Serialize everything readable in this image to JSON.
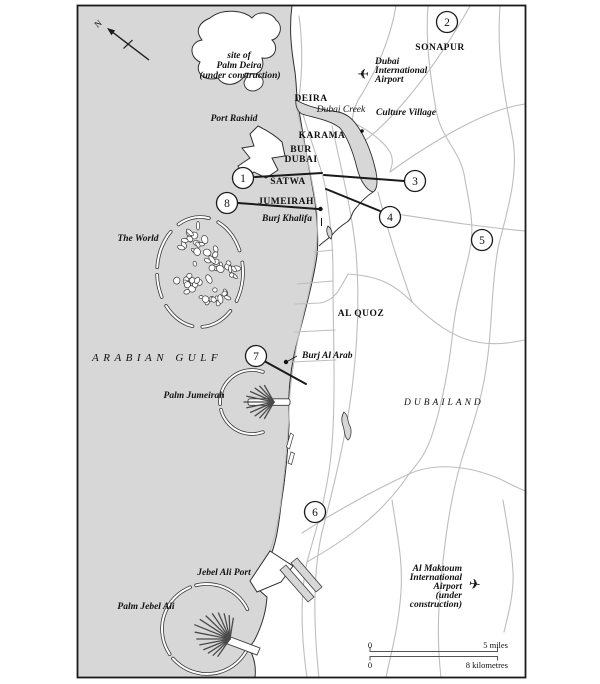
{
  "map_type": "city-map",
  "city": "Dubai",
  "colors": {
    "sea": "#d7d7d7",
    "land": "#ffffff",
    "road": "#bdbdbd",
    "coast_outline": "#2e2e2e",
    "text": "#111111",
    "frame": "#1a1a1a"
  },
  "compass": {
    "north_label": "N"
  },
  "regions": {
    "deira": "DEIRA",
    "karama": "KARAMA",
    "bur": "BUR",
    "dubai": "DUBAI",
    "satwa": "SATWA",
    "jumeirah": "JUMEIRAH",
    "sonapur": "SONAPUR",
    "al_quoz": "AL QUOZ",
    "dubailand": "DUBAILAND"
  },
  "water": {
    "gulf": "ARABIAN GULF",
    "creek": "Dubai Creek"
  },
  "landmarks": {
    "palm_deira_site": {
      "line1": "site of",
      "line2": "Palm Deira",
      "line3": "(under construction)"
    },
    "port_rashid": "Port Rashid",
    "culture_village": "Culture Village",
    "dubai_airport": {
      "line1": "Dubai",
      "line2": "International",
      "line3": "Airport"
    },
    "the_world": "The World",
    "burj_khalifa": "Burj Khalifa",
    "burj_al_arab": "Burj Al Arab",
    "palm_jumeirah": "Palm Jumeirah",
    "jebel_ali_port": "Jebel Ali Port",
    "palm_jebel_ali": "Palm Jebel Ali",
    "al_maktoum_airport": {
      "line1": "Al Maktoum",
      "line2": "International",
      "line3": "Airport",
      "line4": "(under",
      "line5": "construction)"
    }
  },
  "markers": [
    {
      "number": "1"
    },
    {
      "number": "2"
    },
    {
      "number": "3"
    },
    {
      "number": "4"
    },
    {
      "number": "5"
    },
    {
      "number": "6"
    },
    {
      "number": "7"
    },
    {
      "number": "8"
    }
  ],
  "scale": {
    "zero_top": "0",
    "miles": "5 miles",
    "zero_bottom": "0",
    "kilometres": "8 kilometres"
  },
  "icons": {
    "airplane": "✈"
  }
}
